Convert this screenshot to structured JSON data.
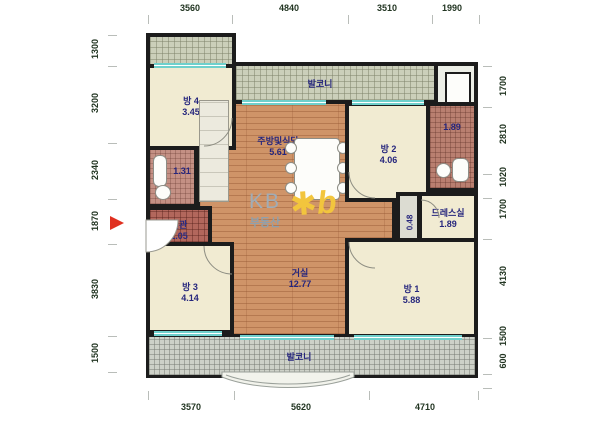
{
  "plan": {
    "branding": {
      "kb": "KB",
      "kb_sub": "부동산",
      "logo_glyph": "✱b"
    },
    "rooms": {
      "bang4": {
        "label": "방 4",
        "area": "3.45"
      },
      "balcony_top": {
        "label": "발코니"
      },
      "kitchen": {
        "label": "주방및식당",
        "area": "5.61"
      },
      "bang2": {
        "label": "방 2",
        "area": "4.06"
      },
      "bath_right": {
        "area": "1.89"
      },
      "dress": {
        "label": "드레스실",
        "area": "1.89"
      },
      "hall": {
        "area": "0.48"
      },
      "bath_left": {
        "area": "1.31"
      },
      "entrance": {
        "label": "현관",
        "area": "1.05"
      },
      "living": {
        "label": "거실",
        "area": "12.77"
      },
      "bang3": {
        "label": "방 3",
        "area": "4.14"
      },
      "bang1": {
        "label": "방 1",
        "area": "5.88"
      },
      "balcony_bottom": {
        "label": "발코니"
      }
    },
    "dimensions": {
      "top": [
        "3560",
        "4840",
        "3510",
        "1990"
      ],
      "bottom": [
        "3570",
        "5620",
        "4710"
      ],
      "left": [
        "1300",
        "3200",
        "2340",
        "1870",
        "3830",
        "1500"
      ],
      "right": [
        "1700",
        "2810",
        "1020",
        "1700",
        "4130",
        "1500",
        "600"
      ]
    },
    "colors": {
      "wall": "#1c1c1c",
      "wood_floor": "#cf9468",
      "room_cream": "#f1ebd2",
      "balcony_olive": "#cbcfba",
      "balcony_gray": "#cdd1c8",
      "bath_tile": "#b97f70",
      "entrance_tile": "#b2675c",
      "window_teal": "#6fd0cc",
      "room_label": "#26267d",
      "dim_text": "#223522",
      "kb_gray": "#a0acb6",
      "kb_gold": "#f2c53d",
      "entry_arrow": "#e03020"
    }
  }
}
